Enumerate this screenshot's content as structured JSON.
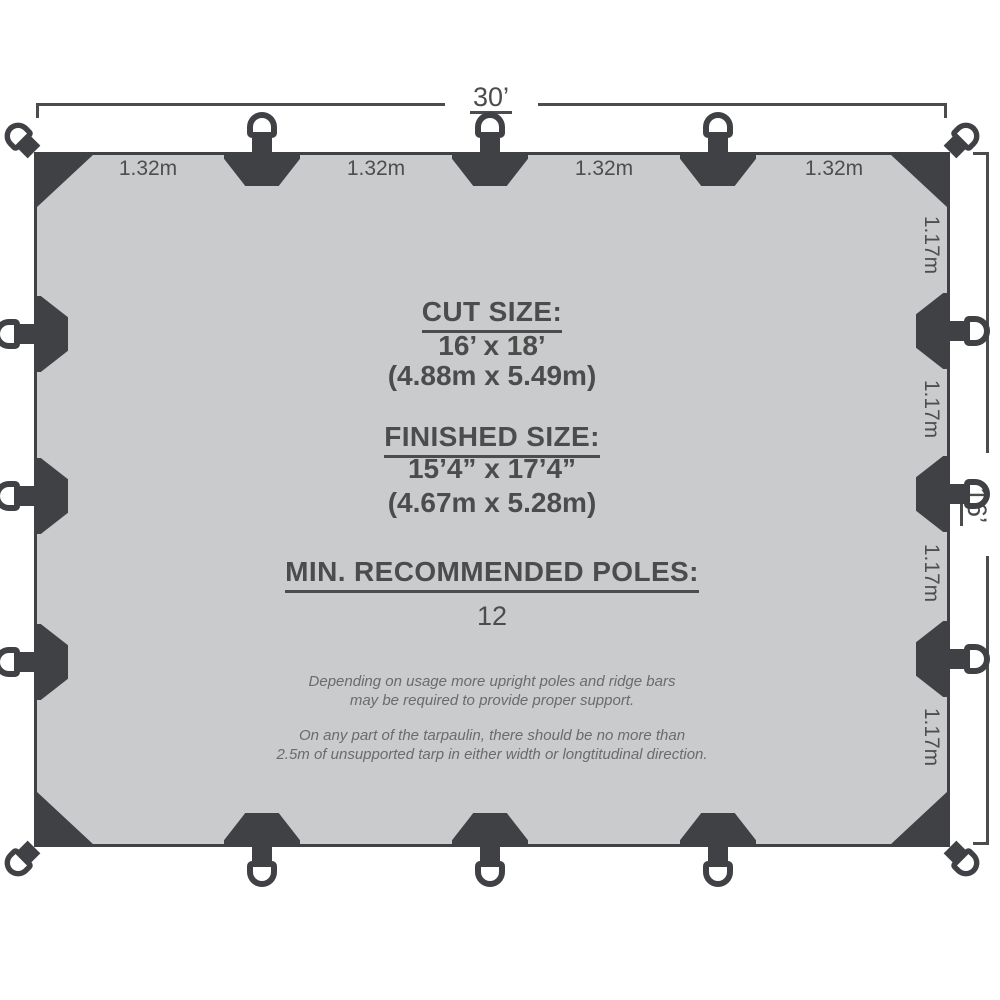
{
  "diagram": {
    "overall": {
      "width_label": "30’",
      "height_label": "16’"
    },
    "top_segments": [
      "1.32m",
      "1.32m",
      "1.32m",
      "1.32m"
    ],
    "side_segments": [
      "1.17m",
      "1.17m",
      "1.17m",
      "1.17m"
    ],
    "cut_size": {
      "heading": "CUT SIZE:",
      "imperial": "16’ x 18’",
      "metric": "(4.88m x 5.49m)"
    },
    "finished_size": {
      "heading": "FINISHED SIZE:",
      "imperial": "15’4” x 17’4”",
      "metric": "(4.67m x 5.28m)"
    },
    "poles": {
      "heading": "MIN. RECOMMENDED POLES:",
      "value": "12"
    },
    "notes": [
      "Depending on usage more upright poles and ridge bars\nmay be required to provide proper support.",
      "On any part of the tarpaulin, there should be no more than\n2.5m of unsupported tarp in either width or longtitudinal direction."
    ],
    "colors": {
      "tarp_fill": "#c9cbcd",
      "hardware_dark": "#3f4144",
      "text": "#4c4c4c",
      "note_text": "#6b6b6b"
    }
  }
}
